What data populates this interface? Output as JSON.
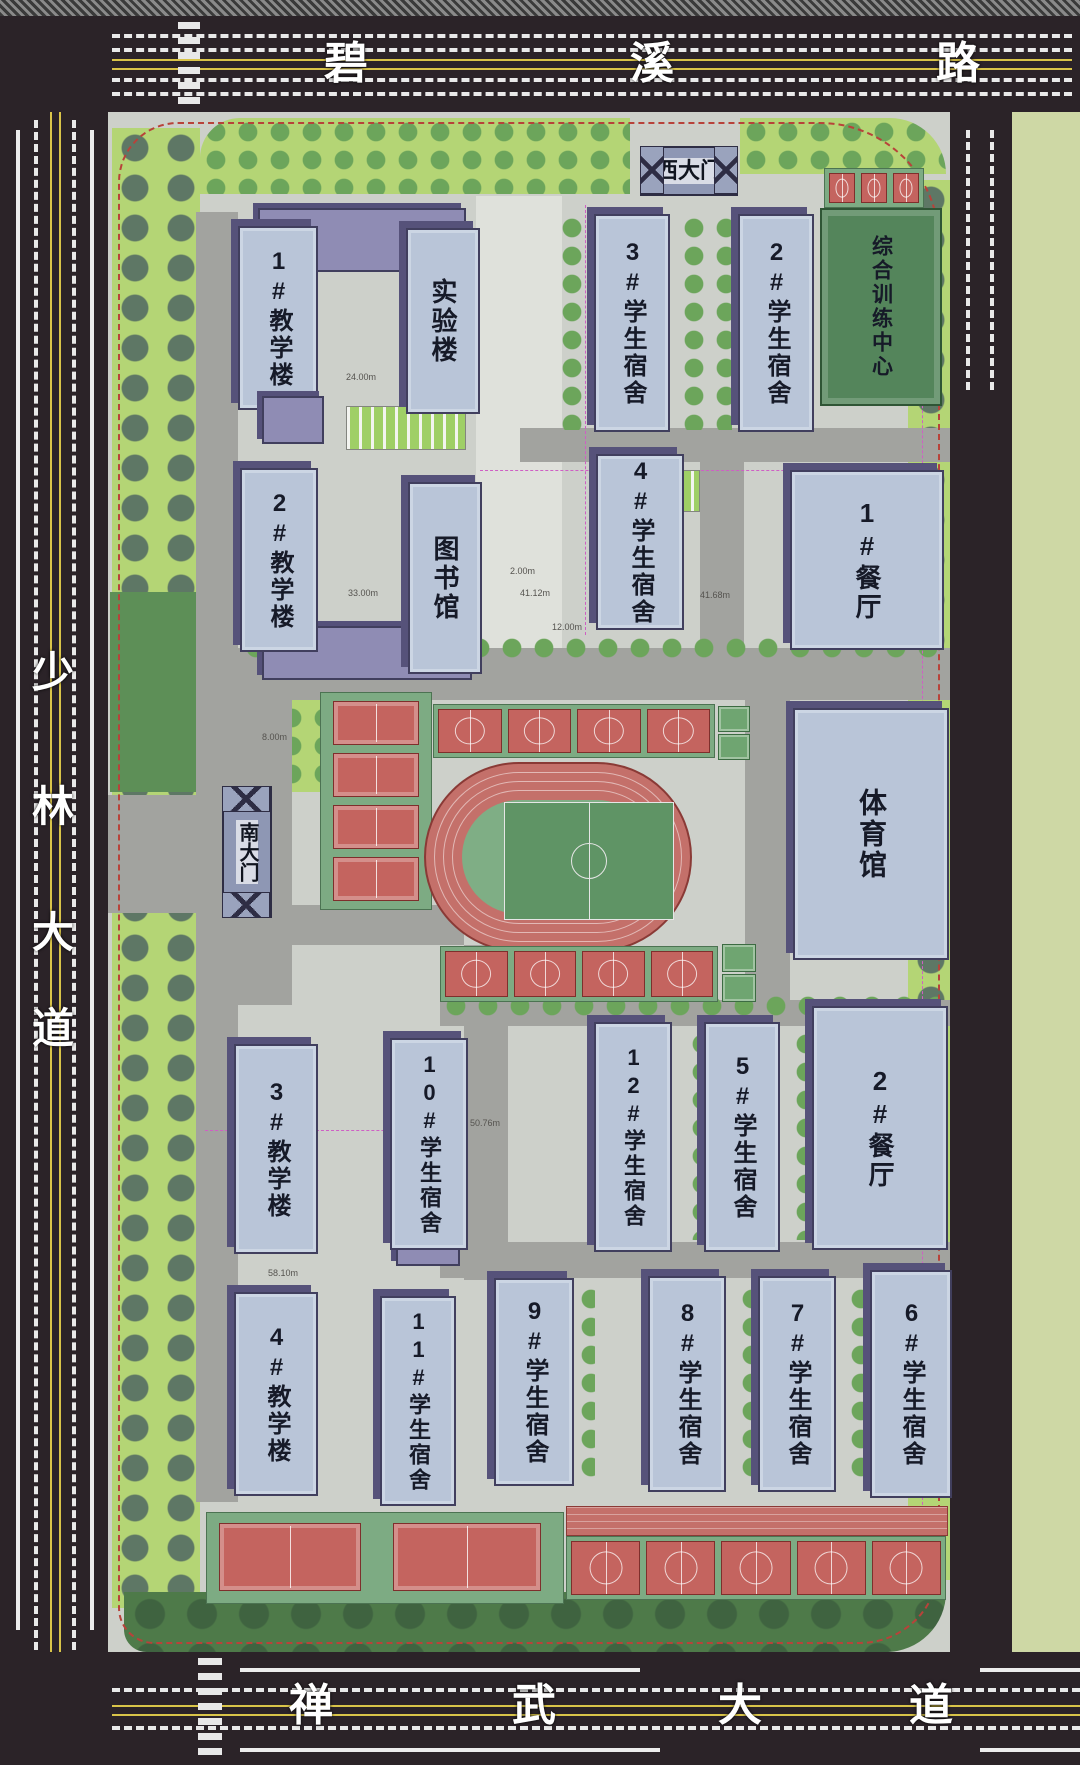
{
  "title": "校园总平面图",
  "roads": {
    "north": {
      "name": "碧溪路",
      "chars": [
        "碧",
        "溪",
        "路"
      ]
    },
    "west": {
      "name": "少林大道",
      "chars": [
        "少",
        "林",
        "大",
        "道"
      ]
    },
    "south": {
      "name": "禅武大道",
      "chars": [
        "禅",
        "武",
        "大",
        "道"
      ]
    }
  },
  "gates": {
    "west": "西大门",
    "south": "南大门"
  },
  "buildings": [
    {
      "label": "1#教学楼"
    },
    {
      "label": "实验楼"
    },
    {
      "label": "3#学生宿舍"
    },
    {
      "label": "2#学生宿舍"
    },
    {
      "label": "综合训练中心"
    },
    {
      "label": "2#教学楼"
    },
    {
      "label": "图书馆"
    },
    {
      "label": "4#学生宿舍"
    },
    {
      "label": "1#餐厅"
    },
    {
      "label": "体育馆"
    },
    {
      "label": "3#教学楼"
    },
    {
      "label": "10#学生宿舍"
    },
    {
      "label": "12#学生宿舍"
    },
    {
      "label": "5#学生宿舍"
    },
    {
      "label": "2#餐厅"
    },
    {
      "label": "4#教学楼"
    },
    {
      "label": "11#学生宿舍"
    },
    {
      "label": "9#学生宿舍"
    },
    {
      "label": "8#学生宿舍"
    },
    {
      "label": "7#学生宿舍"
    },
    {
      "label": "6#学生宿舍"
    }
  ],
  "dimensions": [
    "24.00m",
    "33.00m",
    "41.12m",
    "41.68m",
    "50.76m",
    "58.10m",
    "12.00m",
    "8.00m",
    "2.00m"
  ],
  "colors": {
    "road": "#2b2328",
    "road_yellow": "#d9c449",
    "campus": "#cdd0ca",
    "building": "#b9c5d8",
    "building_shadow": "#56527a",
    "lawn": "#b4d575",
    "dark_green": "#4e7a49",
    "court_red": "#c4645f",
    "track_red": "#c4706a",
    "field_green": "#54855b",
    "boundary_red": "#b8423a",
    "east_green": "#ced8a5"
  }
}
